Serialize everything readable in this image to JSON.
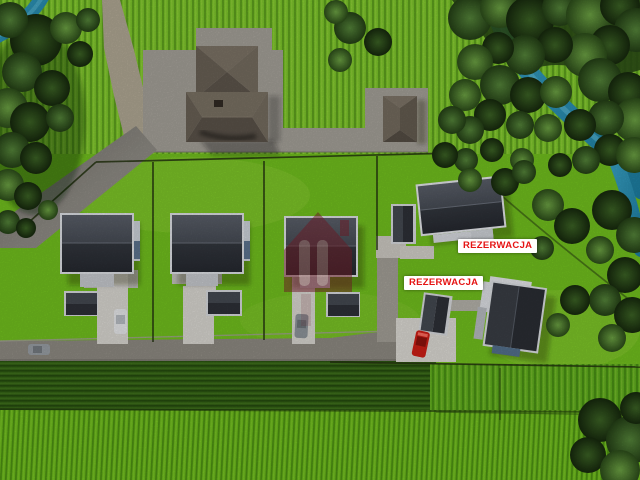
{
  "scene": {
    "description": "Aerial 3D visualization of a residential plot development beside a river and crop fields",
    "labels": [
      {
        "text": "REZERWACJA",
        "color": "#e51414",
        "background": "#ffffff"
      },
      {
        "text": "REZERWACJA",
        "color": "#e51414",
        "background": "#ffffff"
      }
    ],
    "watermark": {
      "name": "developer-house-logo",
      "color": "#7e1f2b"
    },
    "objects": {
      "new_houses": 5,
      "existing_house": 1,
      "garages": 6,
      "cars": 4
    },
    "palette": {
      "grass": "#74c21f",
      "field_top": "#7cc62a",
      "field_bottom": "#6cbd1c",
      "hedge_band": "#356316",
      "forest": "#2a4a15",
      "water": "#2e9dbf",
      "road": "#8f8b83",
      "pavement": "#a6a29a",
      "driveway": "#dbd9d3",
      "roof_dark": "#31353c",
      "roof_light": "#555a63",
      "roof_taupe": "#6f665a",
      "wall_white": "#dfe2e6",
      "wall_blue": "#5e7590",
      "fence": "#253410",
      "car_red": "#cf1f16",
      "car_white": "#e9eaec",
      "car_gray": "#9aa0a6"
    }
  }
}
